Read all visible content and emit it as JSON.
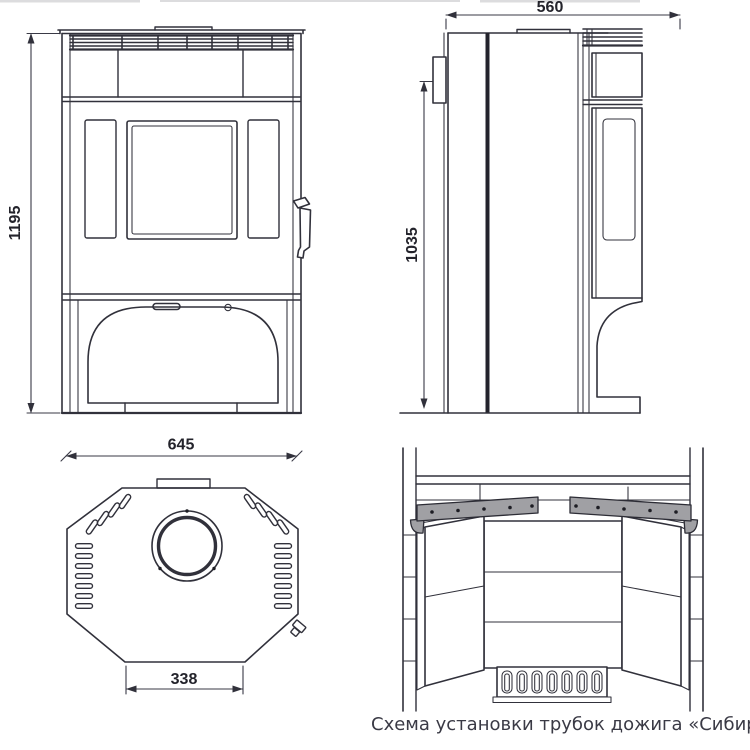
{
  "caption": "Схема установки трубок дожига «Сибирь-12'",
  "dimensions": {
    "front_height": "1195",
    "side_depth": "560",
    "side_height": "1035",
    "top_width": "645",
    "top_base": "338"
  }
}
